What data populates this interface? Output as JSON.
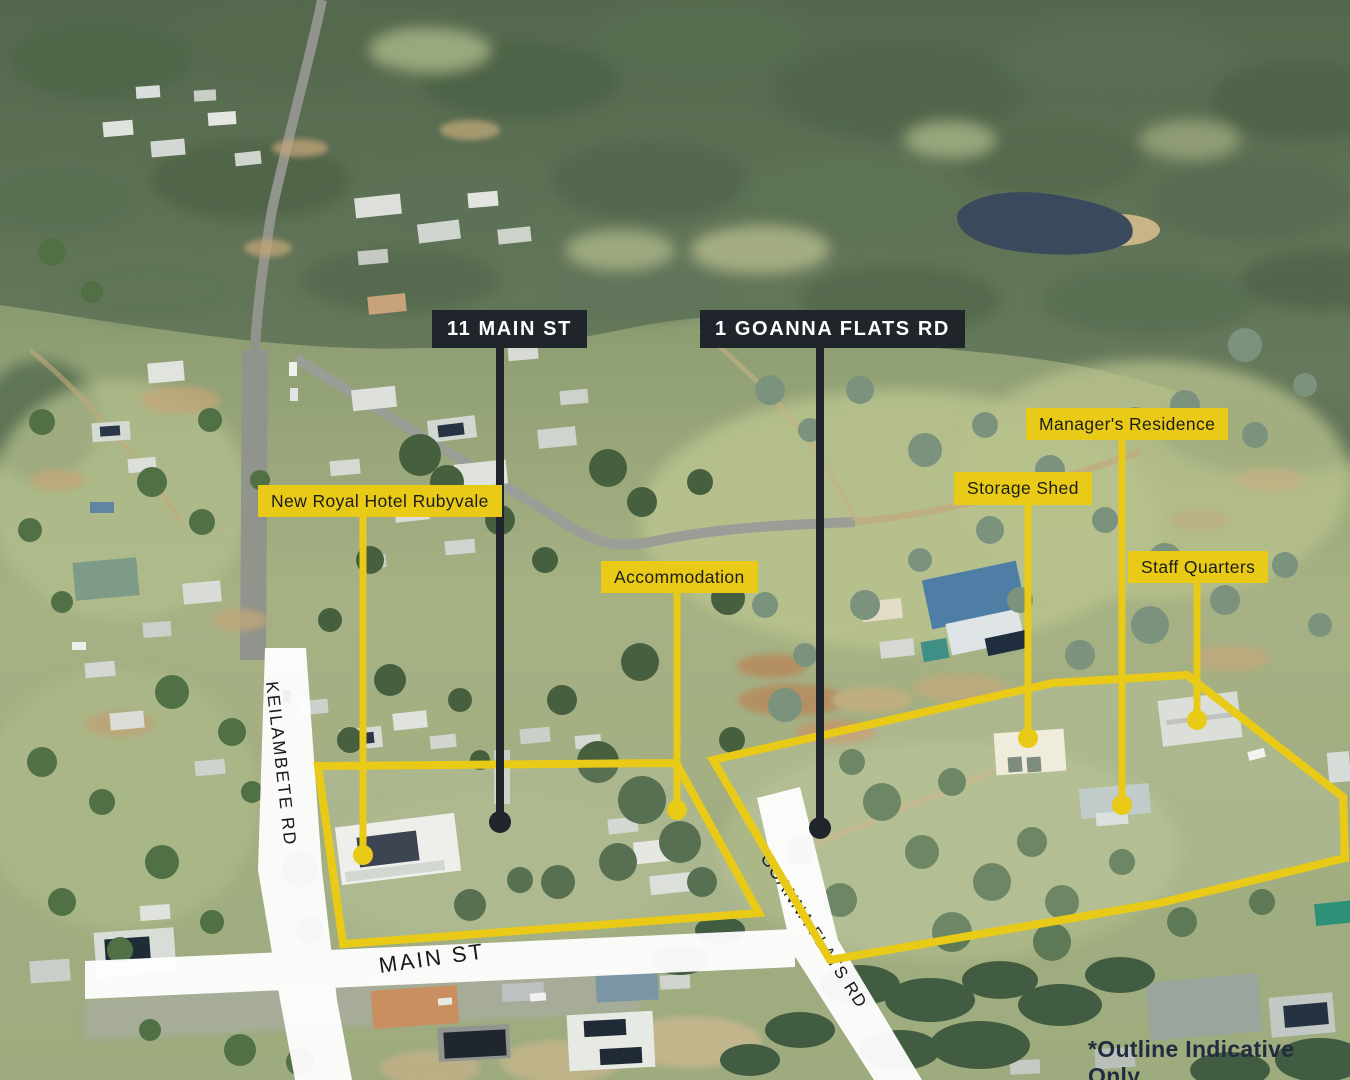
{
  "labels": {
    "address_main_st": "11 MAIN ST",
    "address_goanna": "1 GOANNA FLATS RD",
    "hotel": "New Royal Hotel Rubyvale",
    "accommodation": "Accommodation",
    "storage_shed": "Storage Shed",
    "managers_residence": "Manager's Residence",
    "staff_quarters": "Staff Quarters"
  },
  "roads": {
    "keilambete": "KEILAMBETE RD",
    "main_st": "MAIN ST",
    "goanna_flats": "GOANNA FLATS RD"
  },
  "disclaimer": "*Outline Indicative Only",
  "colors": {
    "accent_yellow": "#e9ca16",
    "label_black": "#20242b",
    "label_text_light": "#ffffff",
    "label_text_dark": "#1d1d1b",
    "disclaimer_navy": "#222c40",
    "road_overlay_white": "#ffffff"
  }
}
